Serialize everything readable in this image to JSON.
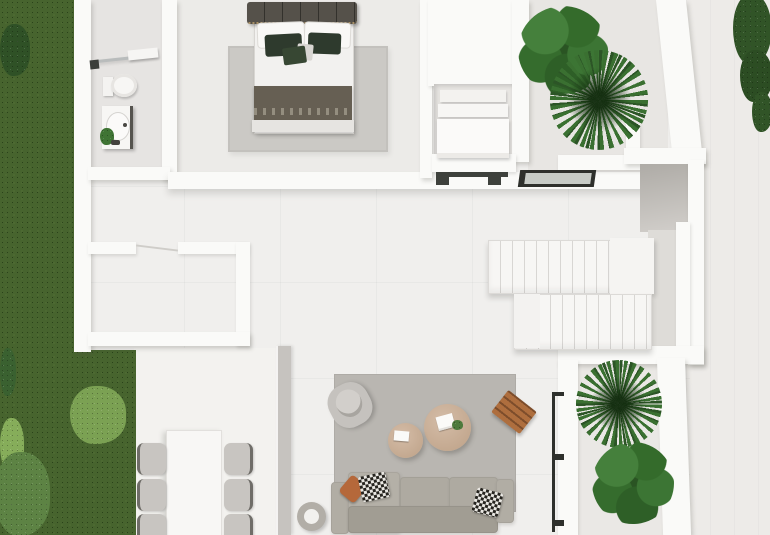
{
  "scene": {
    "type": "architectural-3d-floorplan-top-view",
    "visible_text": "none",
    "rooms_visible": [
      "bathroom",
      "bedroom",
      "wardrobe-niche",
      "courtyard-top",
      "stair-hall",
      "storage-room",
      "dining-terrace",
      "living-room",
      "courtyard-bottom",
      "garden",
      "terrace-right"
    ],
    "inventory": {
      "bathroom": [
        "shower-glass",
        "toilet",
        "vanity-sink",
        "small-plant"
      ],
      "bedroom": [
        "double-bed",
        "headboard",
        "pillows",
        "blanket",
        "area-rug"
      ],
      "wardrobe_niche": {
        "shelves": 3
      },
      "courtyard_top": [
        "fiddle-leaf-plant",
        "palm-plant"
      ],
      "stairs": {
        "flights": 2,
        "upper_treads": 10,
        "lower_treads": 11
      },
      "dining": {
        "table": 1,
        "chairs": 6
      },
      "living": [
        "modular-sofa",
        "chaise",
        "armchair",
        "round-coffee-table-large",
        "round-coffee-table-small",
        "wood-slat-side-table",
        "planter-pot",
        "area-rug",
        "pillows"
      ],
      "courtyard_bottom": [
        "palm-plant",
        "fiddle-leaf-plant",
        "black-framed-glass-wall"
      ],
      "garden": {
        "lawn_strips": 2,
        "bushes": 5
      }
    }
  },
  "colors": {
    "grass": "#47642e",
    "plant": "#3a7031",
    "plant-dark": "#2c5526",
    "bush-dark": "#2f5126",
    "bush-light": "#7ba153",
    "floor": "#f0efed",
    "floor-room": "#ecebe8",
    "floor-bath": "#e6e4e2",
    "floor-court": "#e8e6e3",
    "terrace": "#edebe8",
    "wall": "#fafaf8",
    "divider": "#c6c3bf",
    "rug-bed": "#cbc9c5",
    "rug-living": "#b9b6b1",
    "headboard": "#55514a",
    "bed-sheet": "#f2f1ef",
    "pillow-green": "#2e3a2d",
    "blanket": "#665f53",
    "sofa": "#aeaaa1",
    "sofa-back": "#a19d93",
    "chair": "#c8c5c1",
    "chair-wire": "#6f6d68",
    "table-white": "#f8f7f5",
    "coffee-tan": "#c3a88f",
    "wood": "#ae6e3e",
    "accent-orange": "#b5683a",
    "frame-dark": "#2e302c",
    "stair-line": "#d8d6d3",
    "void": "#aeaba6",
    "pot-ring": "#b2aea7"
  }
}
